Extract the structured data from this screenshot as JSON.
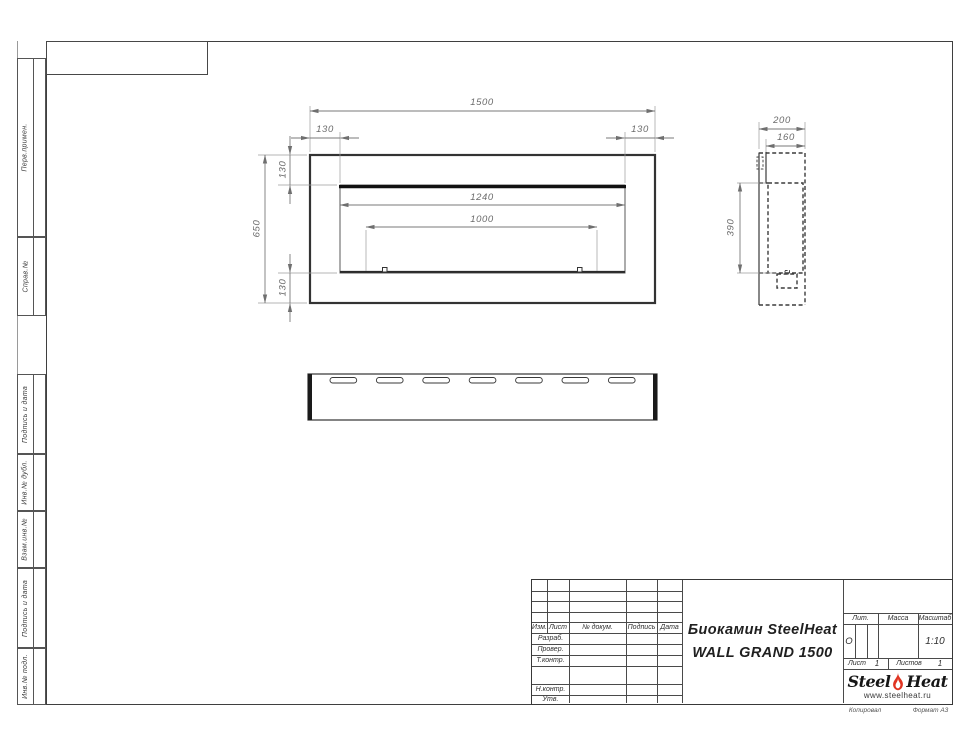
{
  "sheet": {
    "margin_labels_top": [
      "Перв.примен.",
      "Справ.№"
    ],
    "margin_labels_bottom": [
      "Подпись и дата",
      "Инв.№ дубл.",
      "Взам.инв.№",
      "Подпись и дата",
      "Инв.№ подл."
    ],
    "footer": {
      "copied": "Копировал",
      "format": "Формат А3"
    }
  },
  "views": {
    "front": {
      "dim_width": "1500",
      "dim_left": "130",
      "dim_right": "130",
      "dim_height": "650",
      "dim_top": "130",
      "dim_bottom": "130",
      "dim_opening": "1240",
      "dim_burner": "1000"
    },
    "side": {
      "dim_depth": "200",
      "dim_inner_depth": "160",
      "dim_opening_height": "390"
    }
  },
  "title_block": {
    "header_cols": [
      "Изм.",
      "Лист",
      "№ докум.",
      "Подпись",
      "Дата"
    ],
    "approval_rows": [
      "Разраб.",
      "Провер.",
      "Т.контр.",
      "Н.контр.",
      "Утв."
    ],
    "doc_title_line1": "Биокамин SteelHeat",
    "doc_title_line2": "WALL GRAND 1500",
    "lit_label": "Лит.",
    "lit_value": "О",
    "mass_label": "Масса",
    "scale_label": "Масштаб",
    "scale_value": "1:10",
    "sheet_label": "Лист",
    "sheet_value": "1",
    "sheets_label": "Листов",
    "sheets_value": "1",
    "brand": {
      "steel": "Steel",
      "heat": "Heat",
      "url": "www.steelheat.ru"
    },
    "colors": {
      "flame_red": "#e03422",
      "line_dark": "#3f3f3f"
    }
  }
}
